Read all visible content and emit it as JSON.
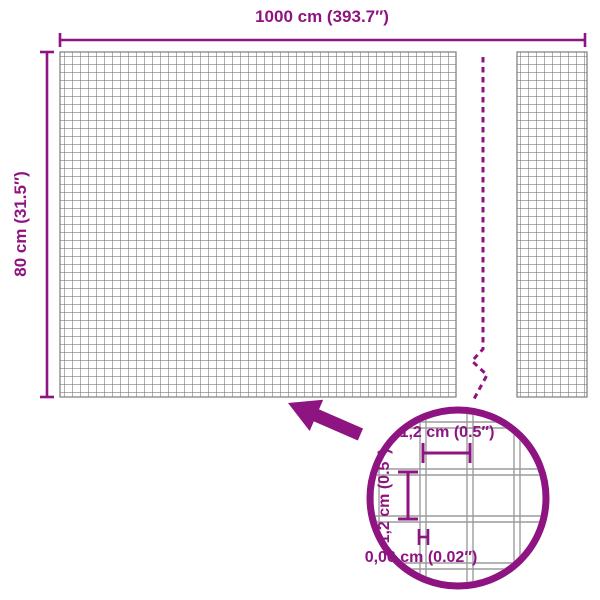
{
  "figure": {
    "description": "Dimension diagram of a wire mesh panel with a break symbol and a magnified detail circle"
  },
  "colors": {
    "accent": "#8E1482",
    "mesh": "#7C7C7C",
    "zoomwire": "#9C9C9C",
    "bg": "#FFFFFF"
  },
  "labels": {
    "total_width": "1000 cm (393.7″)",
    "total_height": "80 cm (31.5″)",
    "cell_width": "1,2 cm (0.5″)",
    "cell_height": "1,2 cm (0.5″)",
    "wire_thickness": "0,06 cm (0.02″)"
  }
}
